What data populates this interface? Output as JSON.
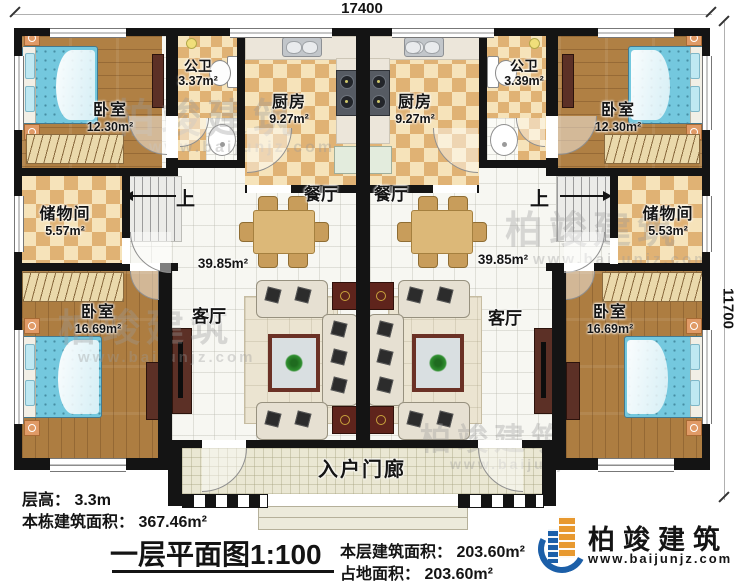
{
  "dimensions": {
    "top": "17400",
    "right": "11700"
  },
  "rooms": {
    "left": {
      "bedroom_top": {
        "name": "卧室",
        "area": "12.30m²"
      },
      "bath": {
        "name": "公卫",
        "area": "3.37m²"
      },
      "kitchen": {
        "name": "厨房",
        "area": "9.27m²"
      },
      "storage": {
        "name": "储物间",
        "area": "5.57m²"
      },
      "dining": {
        "name": "餐厅"
      },
      "living": {
        "name": "客厅"
      },
      "hall_area": "39.85m²",
      "bedroom_bottom": {
        "name": "卧室",
        "area": "16.69m²"
      },
      "stairs_up": "上"
    },
    "right": {
      "bedroom_top": {
        "name": "卧室",
        "area": "12.30m²"
      },
      "bath": {
        "name": "公卫",
        "area": "3.39m²"
      },
      "kitchen": {
        "name": "厨房",
        "area": "9.27m²"
      },
      "storage": {
        "name": "储物间",
        "area": "5.53m²"
      },
      "dining": {
        "name": "餐厅"
      },
      "living": {
        "name": "客厅"
      },
      "hall_area": "39.85m²",
      "bedroom_bottom": {
        "name": "卧室",
        "area": "16.69m²"
      },
      "stairs_up": "上"
    }
  },
  "porch": {
    "label": "入户门廊"
  },
  "notes": {
    "floor_height": "层高： 3.3m",
    "total_area": "本栋建筑面积： 367.46m²"
  },
  "title": {
    "text": "一层平面图1:100"
  },
  "stats": {
    "floor_area": "本层建筑面积： 203.60m²",
    "footprint": "占地面积： 203.60m²"
  },
  "brand": {
    "name": "柏竣建筑",
    "url": "www.baijunjz.com"
  },
  "watermark": {
    "name": "柏竣建筑",
    "url": "www.baijunjz.com"
  },
  "colors": {
    "wall": "#141414",
    "wood": "#b08044",
    "tile_accent": "#e0b274",
    "brand_blue": "#1c5fa8",
    "brand_orange": "#e8992f"
  }
}
